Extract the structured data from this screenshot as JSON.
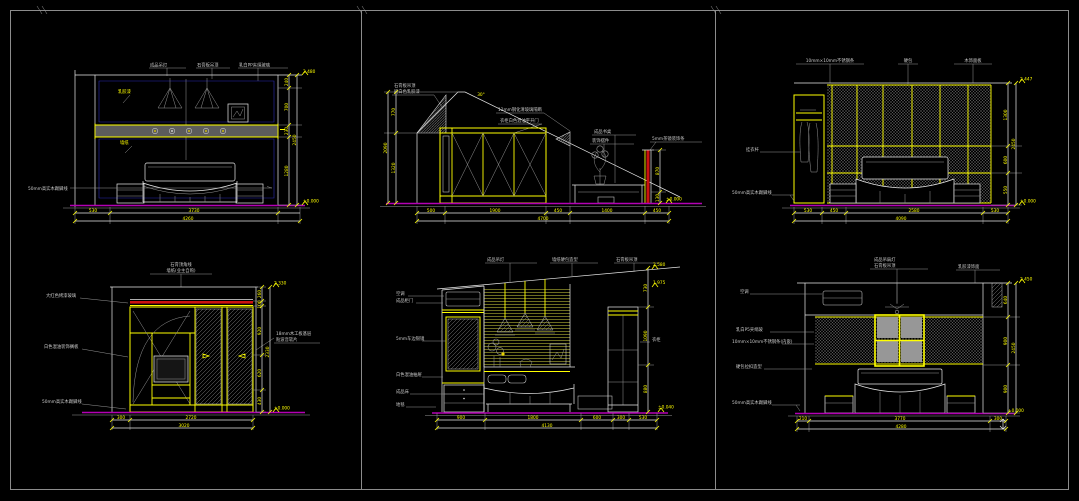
{
  "window": {
    "background": "#000000",
    "border_color": "#8c8c8c"
  },
  "colors": {
    "line_white": "#e8e8e8",
    "accent_yellow": "#ffff00",
    "floor_magenta": "#b400b4",
    "detail_navy": "#2b2bb4",
    "accent_red": "#cc1111",
    "hatch_gray": "#8a8a8a"
  },
  "panels": {
    "p1": {
      "name": "bed-wall-elevation",
      "top_labels": [
        "成品吊灯",
        "石膏板吊顶",
        "乳白PP夹绢玻璃"
      ],
      "inner_labels": [
        "乳胶漆",
        "墙纸"
      ],
      "skirting_label": "50mm高实木踢脚线",
      "dims_right": [
        "240",
        "700",
        "230",
        "1280"
      ],
      "dim_right_total": "2450",
      "elev_top": "2.480",
      "elev_bottom": "±0.000",
      "dims_bottom": [
        "530",
        "3730"
      ],
      "dim_bottom_total": "4260"
    },
    "p2": {
      "name": "sloped-ceiling-wardrobe-elevation",
      "top_labels": [
        "石膏板吊顶",
        "刷白色乳胶漆"
      ],
      "slope_label": "30°",
      "mid_labels": [
        "12mm钢化清玻璃隔断",
        "衣柜白色混油平开门"
      ],
      "right_labels": [
        "成品书桌",
        "装饰摆件",
        "5mm茶镜装饰条"
      ],
      "dims_left": [
        "770",
        "1320"
      ],
      "dim_left_total": "2090",
      "dims_right": [
        "870",
        "130"
      ],
      "elev_bottom": "±0.000",
      "dims_bottom": [
        "500",
        "1900",
        "450",
        "1400",
        "450"
      ],
      "dim_bottom_total": "4700"
    },
    "p3": {
      "name": "headboard-panel-wall-elevation",
      "top_labels": [
        "10mm×10mm不锈钢条",
        "硬包",
        "木饰面板"
      ],
      "left_labels": [
        "挂衣杆",
        "50mm高实木踢脚线"
      ],
      "dims_right": [
        "1300",
        "600",
        "550"
      ],
      "dim_right_total": "2450",
      "elev_top": "2.447",
      "elev_bottom": "±0.000",
      "dims_bottom": [
        "530",
        "450",
        "2580",
        "530"
      ],
      "dim_bottom_total": "4090"
    },
    "p4": {
      "name": "tv-wardrobe-elevation",
      "top_labels": [
        "石膏顶角线",
        "墙纸(业主自购)"
      ],
      "left_labels": [
        "大红色烤漆玻璃",
        "白色混油装饰搁板",
        "50mm高实木踢脚线"
      ],
      "right_labels": [
        "18mm木工板基层",
        "贴波音软片"
      ],
      "dims_right": [
        "260",
        "100",
        "920",
        "620",
        "430"
      ],
      "dim_right_total": "2330",
      "elev_top": "2.330",
      "elev_bottom": "±0.000",
      "dims_bottom": [
        "300",
        "2720"
      ],
      "dim_bottom_total": "3020"
    },
    "p5": {
      "name": "striped-headboard-elevation",
      "top_labels": [
        "成品吊灯",
        "墙纸硬包造型",
        "石膏板吊顶"
      ],
      "left_labels": [
        "空调",
        "成品柜门",
        "5mm车边银镜",
        "白色混油抽屉",
        "成品床",
        "地毯"
      ],
      "right_label": "衣柜",
      "dims_right": [
        "730",
        "1090",
        "880"
      ],
      "elev_top": "2.580",
      "elev_mid": "1.975",
      "elev_bottom": "±0.040",
      "dims_bottom": [
        "900",
        "1800",
        "600",
        "300",
        "530"
      ],
      "dim_bottom_total": "4130"
    },
    "p6": {
      "name": "diamond-headboard-elevation",
      "top_labels": [
        "成品吊扇灯",
        "石膏板吊顶",
        "乳胶漆饰面"
      ],
      "left_labels": [
        "空调",
        "乳白P5夹绢玻",
        "10mm×10mm不锈钢条(内嵌)",
        "硬包拉扣造型",
        "50mm高实木踢脚线"
      ],
      "dims_right": [
        "640",
        "900",
        "900"
      ],
      "dim_right_total": "2450",
      "elev_top": "2.450",
      "elev_bottom": "±0.000",
      "dims_bottom": [
        "210",
        "3770",
        "300"
      ],
      "dim_bottom_total": "4280"
    }
  }
}
